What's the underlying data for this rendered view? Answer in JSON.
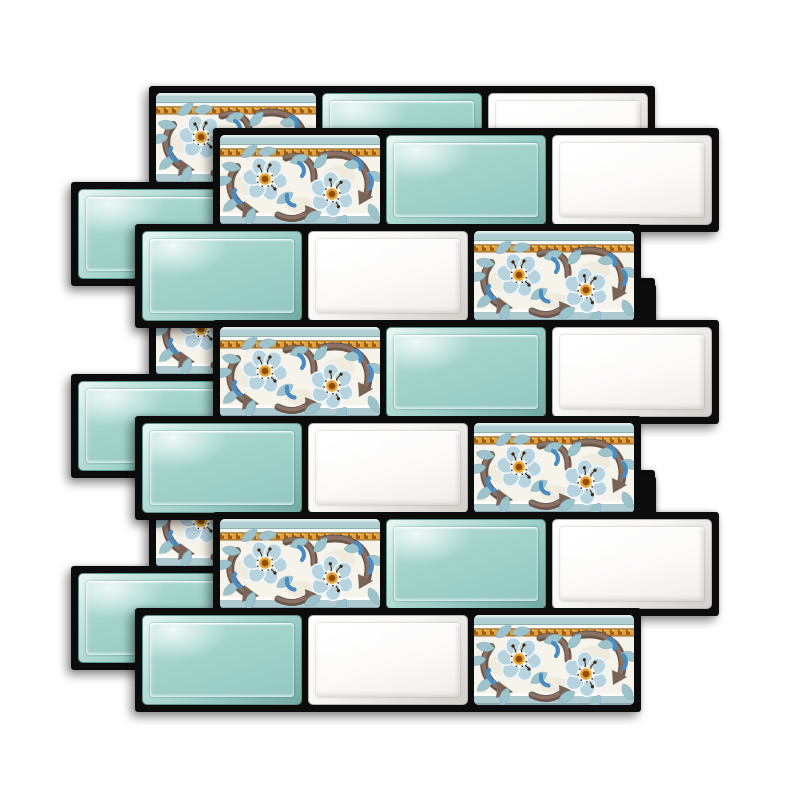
{
  "product": {
    "kind": "peel-and-stick mosaic tile sheet",
    "sheets_visible": 2,
    "pattern": "staggered subway bricks with floral ceramic border strips",
    "tile_types": [
      "floral",
      "teal",
      "white"
    ]
  },
  "canvas": {
    "width": 800,
    "height": 800,
    "background": "#ffffff"
  },
  "palette": {
    "grout": "#0c0c0c",
    "teal_face": "#a2d3cb",
    "teal_edge": "#5d948d",
    "white_face": "#fbfaf9",
    "white_edge": "#b7b4b0",
    "cream": "#f5f3ea",
    "band_teal": "#b2cfd3",
    "band_gold": "#dfa23c",
    "gold_dark": "#8a5a1e",
    "petal_blue": "#b6d3df",
    "leaf_teal": "#9cc2cb",
    "swirl_brown": "#8a7265",
    "accent_blue": "#4a8cc2",
    "flower_core": "#8f4c0b",
    "flower_ring": "#e7a639"
  },
  "layout": {
    "tile_width": 160,
    "tile_height": 90,
    "tile_gap": 6,
    "row_pitch": 96,
    "sheet_border": 7,
    "tab": {
      "width": 16,
      "height": 42,
      "rise": 36
    },
    "sheets": [
      {
        "id": "back",
        "dx": -64,
        "dy": -42
      },
      {
        "id": "front",
        "dx": 0,
        "dy": 0
      }
    ],
    "rows": [
      {
        "y": 135,
        "x": 220,
        "tiles": [
          "floral",
          "teal",
          "white"
        ],
        "tab_right": false
      },
      {
        "y": 231,
        "x": 142,
        "tiles": [
          "teal",
          "white",
          "floral"
        ],
        "tab_right": true
      },
      {
        "y": 327,
        "x": 220,
        "tiles": [
          "floral",
          "teal",
          "white"
        ],
        "tab_right": false
      },
      {
        "y": 423,
        "x": 142,
        "tiles": [
          "teal",
          "white",
          "floral"
        ],
        "tab_right": true
      },
      {
        "y": 519,
        "x": 220,
        "tiles": [
          "floral",
          "teal",
          "white"
        ],
        "tab_right": false
      },
      {
        "y": 615,
        "x": 142,
        "tiles": [
          "teal",
          "white",
          "floral"
        ],
        "tab_right": false
      }
    ]
  }
}
